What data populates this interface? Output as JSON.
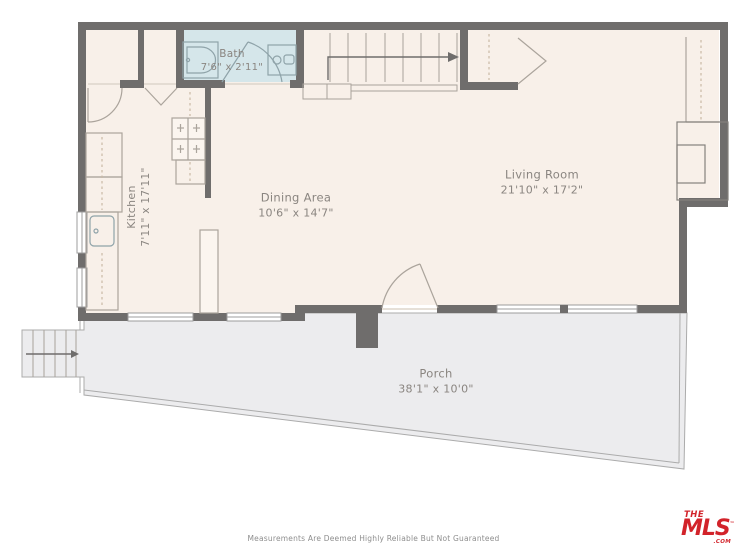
{
  "plan": {
    "rooms": {
      "bath": {
        "name": "Bath",
        "dims": "7'6\" x 2'11\""
      },
      "kitchen": {
        "name": "Kitchen",
        "dims": "7'11\" x 17'11\""
      },
      "dining": {
        "name": "Dining Area",
        "dims": "10'6\" x 14'7\""
      },
      "living": {
        "name": "Living Room",
        "dims": "21'10\" x 17'2\""
      },
      "porch": {
        "name": "Porch",
        "dims": "38'1\" x 10'0\""
      }
    },
    "colors": {
      "wall": "#6F6D6C",
      "floor": "#F8F0E9",
      "bath": "#D5E6EA",
      "porch": "#ECECEE",
      "rail": "#ABABAB",
      "fixture": "#ABA49C",
      "bathfix": "#8FA3A9",
      "window": "#9C9C9C",
      "threshold": "#DDD5CC",
      "dash": "#C9B9A6",
      "hatch": "#8B8B8B",
      "text": "#8A8580",
      "accent": "#D2232A"
    }
  },
  "footer": {
    "disclaimer": "Measurements Are Deemed Highly Reliable But Not Guaranteed",
    "logo": {
      "the": "THE",
      "mls": "MLS",
      "tm": "™",
      "com": ".COM"
    }
  }
}
